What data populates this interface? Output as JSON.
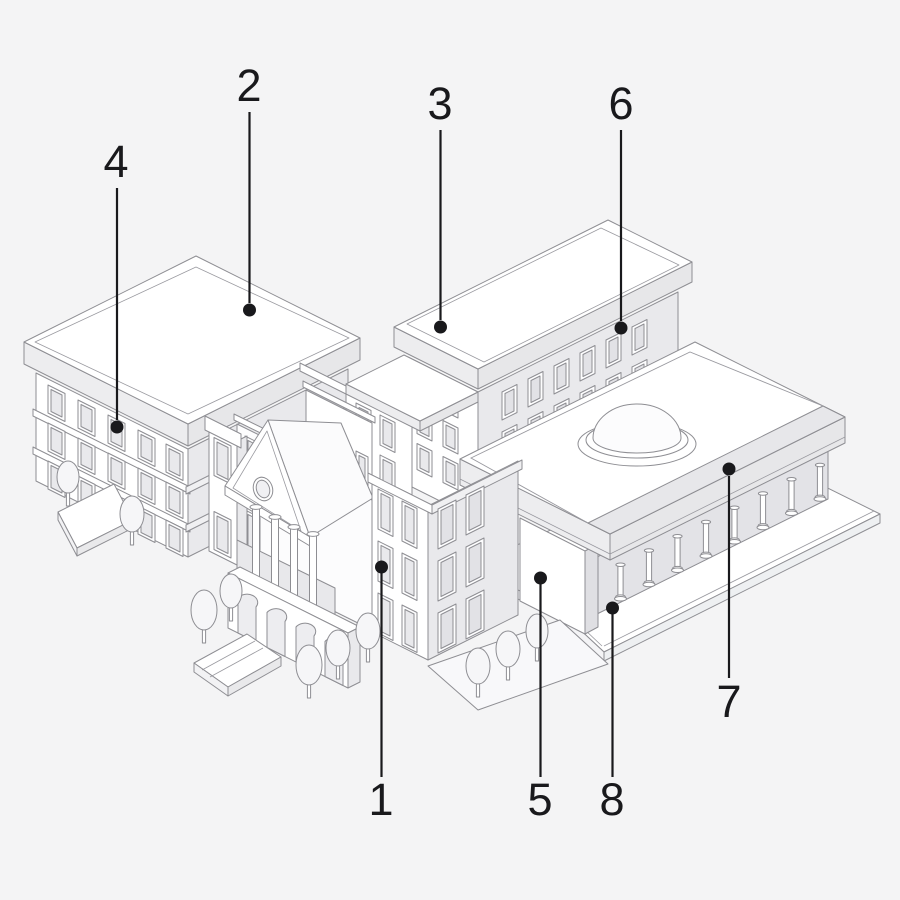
{
  "illustration": {
    "background_color": "#f4f4f5",
    "outline_color": "#8e8e93",
    "ink_color": "#19191c"
  },
  "labels": [
    {
      "number": "1"
    },
    {
      "number": "2"
    },
    {
      "number": "3"
    },
    {
      "number": "4"
    },
    {
      "number": "5"
    },
    {
      "number": "6"
    },
    {
      "number": "7"
    },
    {
      "number": "8"
    }
  ]
}
